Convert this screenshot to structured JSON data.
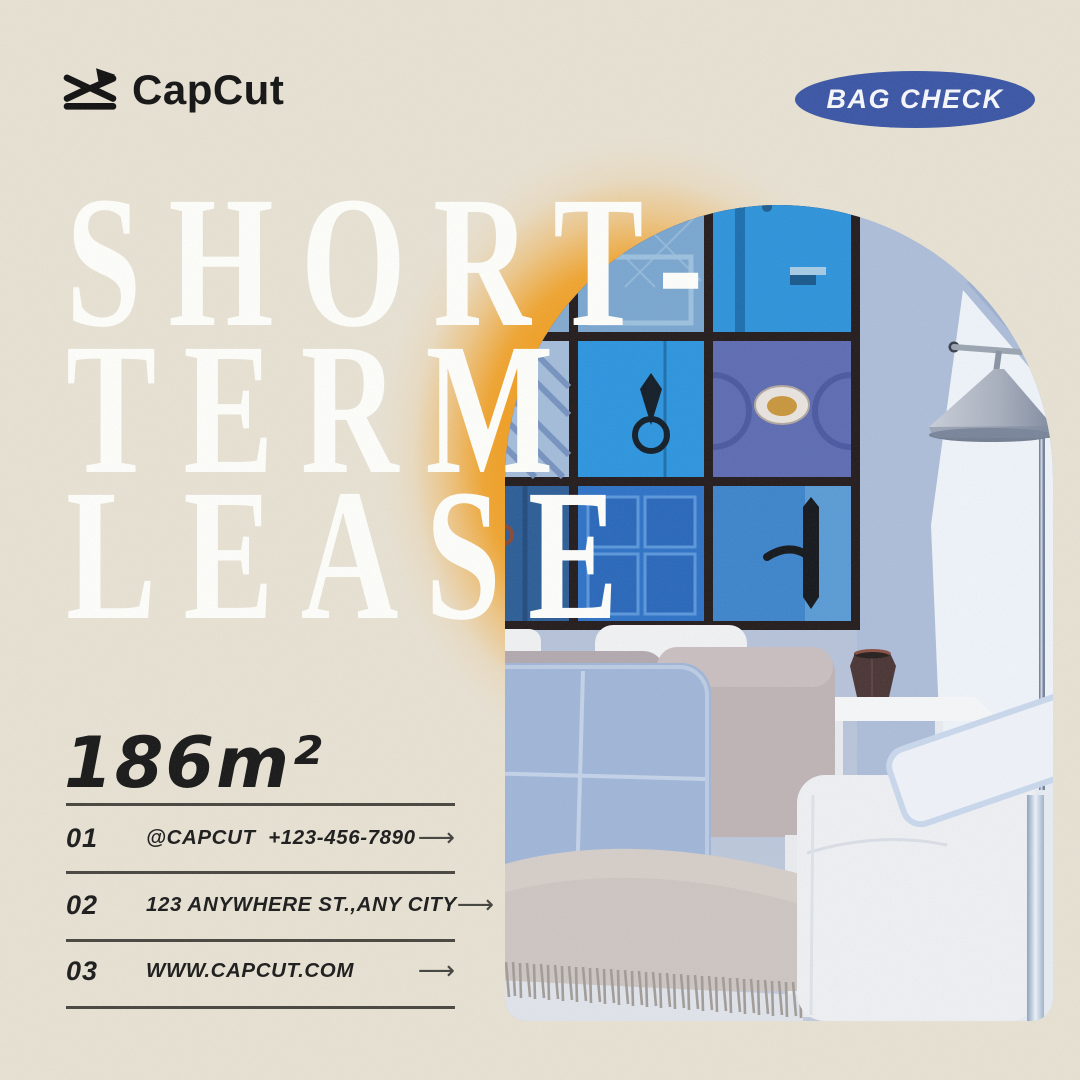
{
  "brand": {
    "logo_text": "CapCut"
  },
  "badge": {
    "label": "BAG CHECK"
  },
  "headline": {
    "line1": "SHORT-",
    "line2": "TERM",
    "line3": "LEASE"
  },
  "area": {
    "value": "186m²"
  },
  "contact_rows": [
    {
      "index": "01",
      "label": "@CAPCUT  +123-456-7890",
      "arrow": "⟶"
    },
    {
      "index": "02",
      "label": "123 ANYWHERE ST.,ANY CITY",
      "arrow": "⟶"
    },
    {
      "index": "03",
      "label": "WWW.CAPCUT.COM",
      "arrow": "⟶"
    }
  ],
  "colors": {
    "background_beige": "#e7e1d3",
    "badge_blue": "#3b56a5",
    "glow_orange": "#f09c1c",
    "headline_white": "#fdfdfa",
    "text_black": "#1c1c1c",
    "rule_gray": "#48463f",
    "photo_wall_blue": "#b5c1d8",
    "door_bright_blue": "#2e95de",
    "door_purple_blue": "#5e6cb2"
  },
  "icons": {
    "capcut_logo_icon": "capcut-bowtie-mark",
    "arrow_icon": "long-right-arrow"
  }
}
